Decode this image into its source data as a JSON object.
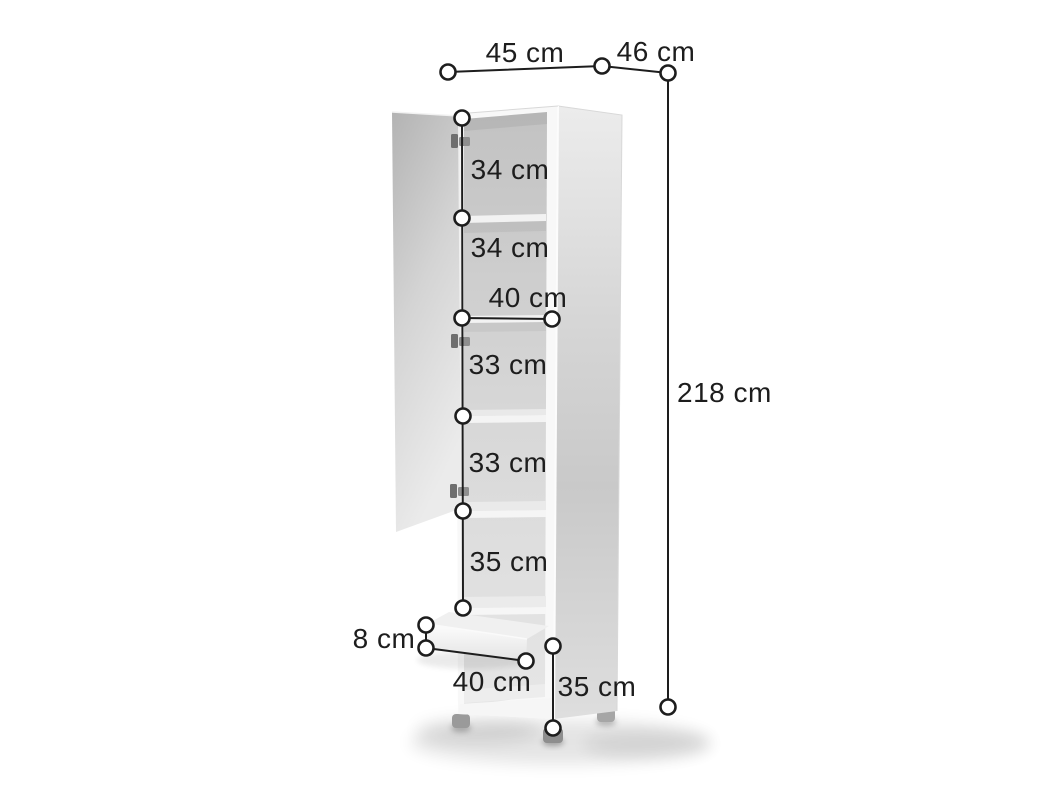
{
  "diagram": {
    "type": "furniture-dimension-diagram",
    "subject": "tall cabinet with open door, five shelf compartments and one drawer"
  },
  "measurements": {
    "top_width": "45 cm",
    "top_depth": "46 cm",
    "total_height": "218 cm",
    "shelf_sections": [
      "34 cm",
      "34 cm",
      "33 cm",
      "33 cm",
      "35 cm"
    ],
    "interior_width": "40 cm",
    "drawer_height": "8 cm",
    "drawer_width": "40 cm",
    "bottom_height": "35 cm"
  },
  "colors": {
    "background": "#ffffff",
    "annotation_line": "#1d1d1d",
    "annotation_text": "#1d1d1d",
    "endpoint_fill": "#ffffff",
    "cabinet_body": "#f8f8f8",
    "cabinet_interior_top": "#c2c2c2",
    "cabinet_interior_bottom": "#e6e6e6",
    "door_top": "#b3b3b3",
    "door_bottom": "#ebebeb",
    "side_panel": "#d2d2d2",
    "shelf": "#f2f2f2",
    "hinge": "#6e6e6e",
    "feet": "#969696",
    "floor_shadow": "#000000"
  }
}
